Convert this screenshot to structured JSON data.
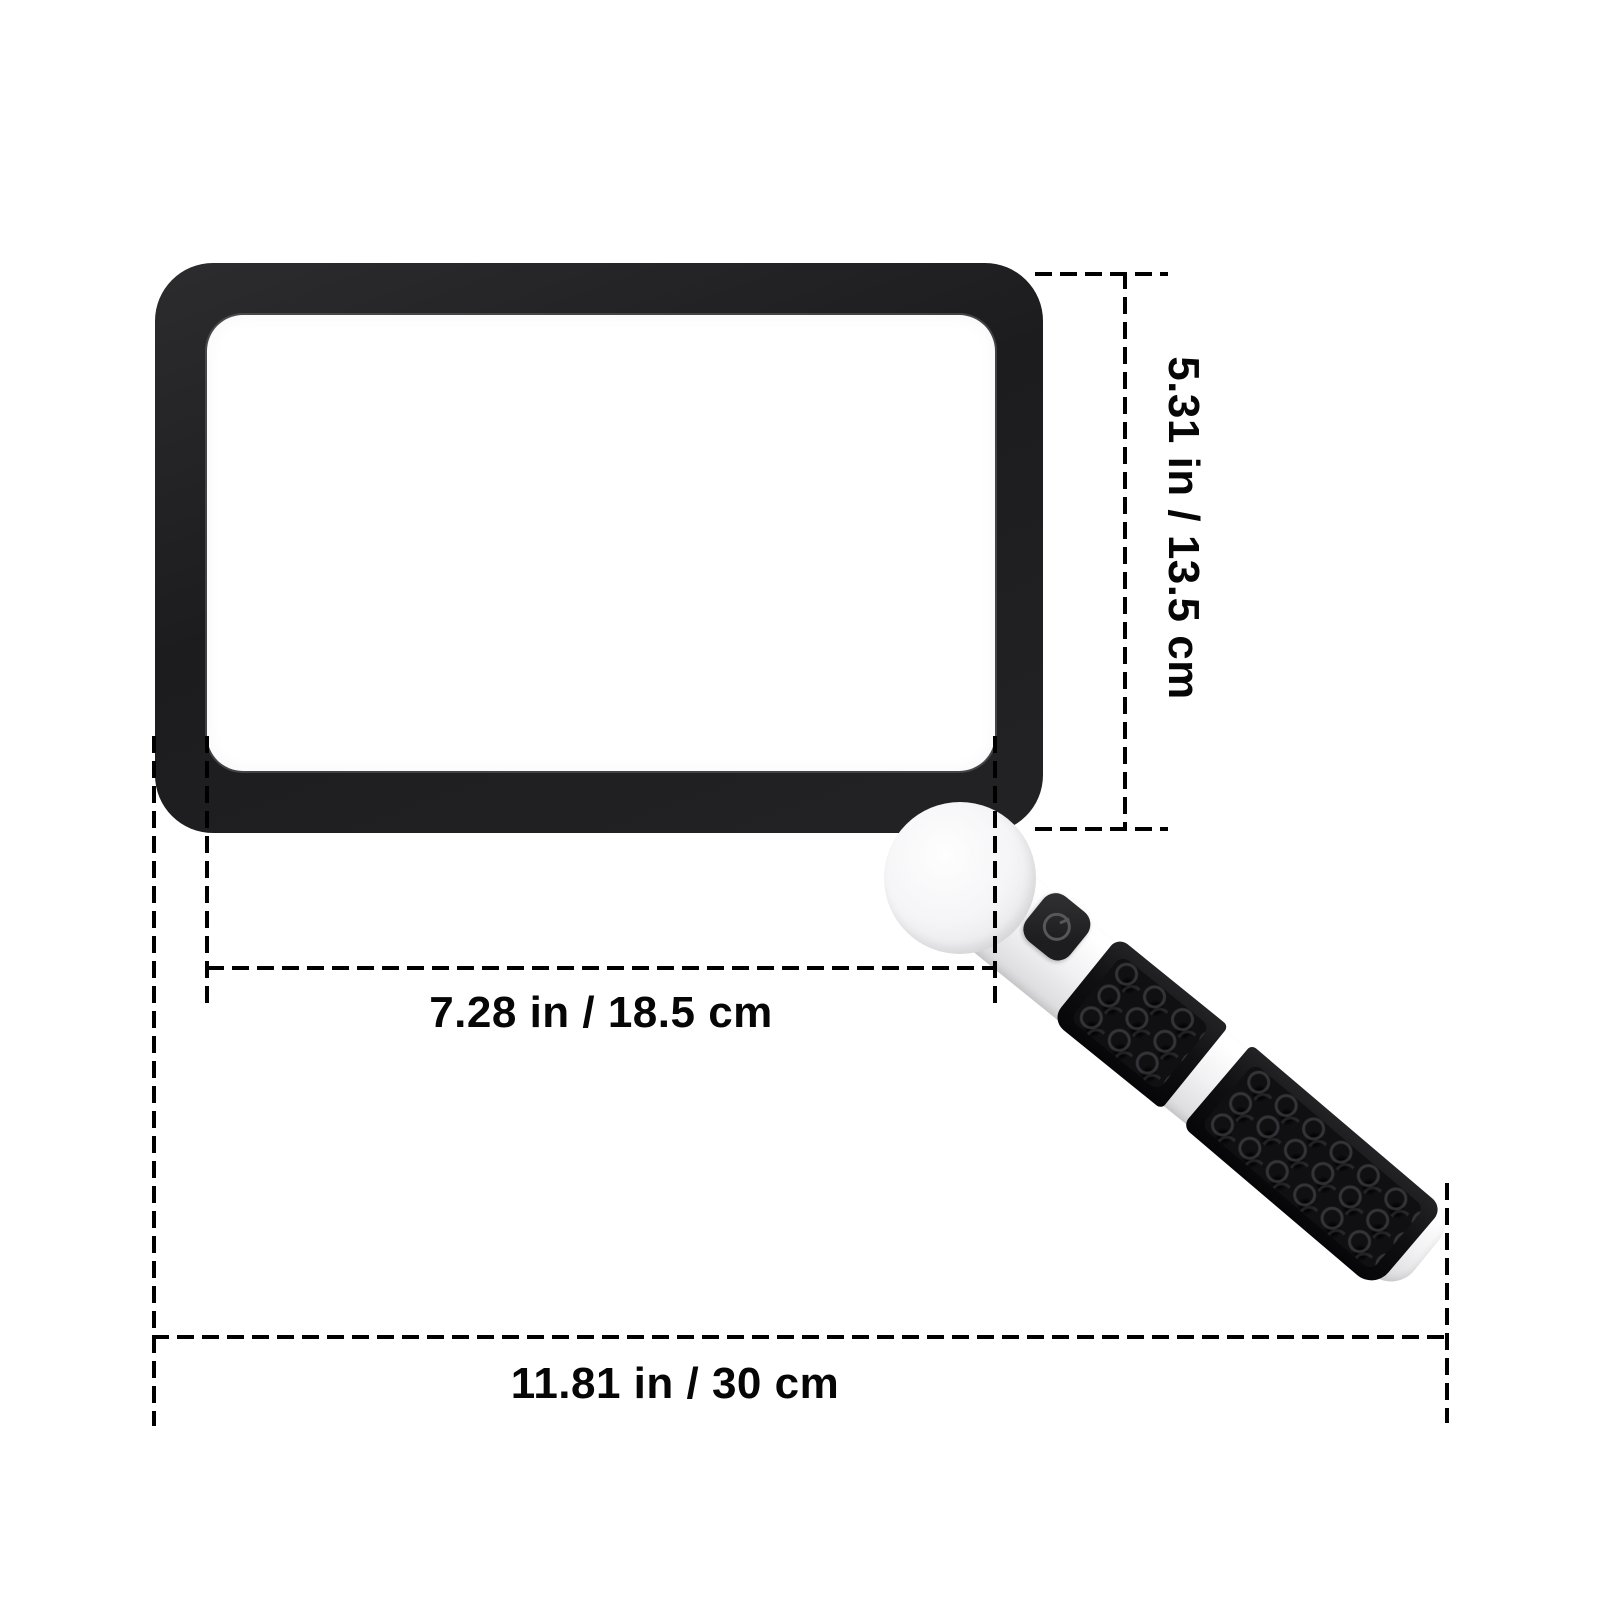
{
  "diagram": {
    "subject": "rectangular-magnifier-with-folding-handle",
    "background_color": "#ffffff",
    "line_color": "#000000",
    "frame_color": "#1e1e20",
    "handle_color": "#f2f2f4",
    "grip_color": "#101013",
    "labels": {
      "height": "5.31 in / 13.5 cm",
      "lens_width": "7.28 in / 18.5 cm",
      "total_length": "11.81 in / 30 cm"
    },
    "icons": {
      "power_button": "power-icon"
    }
  }
}
